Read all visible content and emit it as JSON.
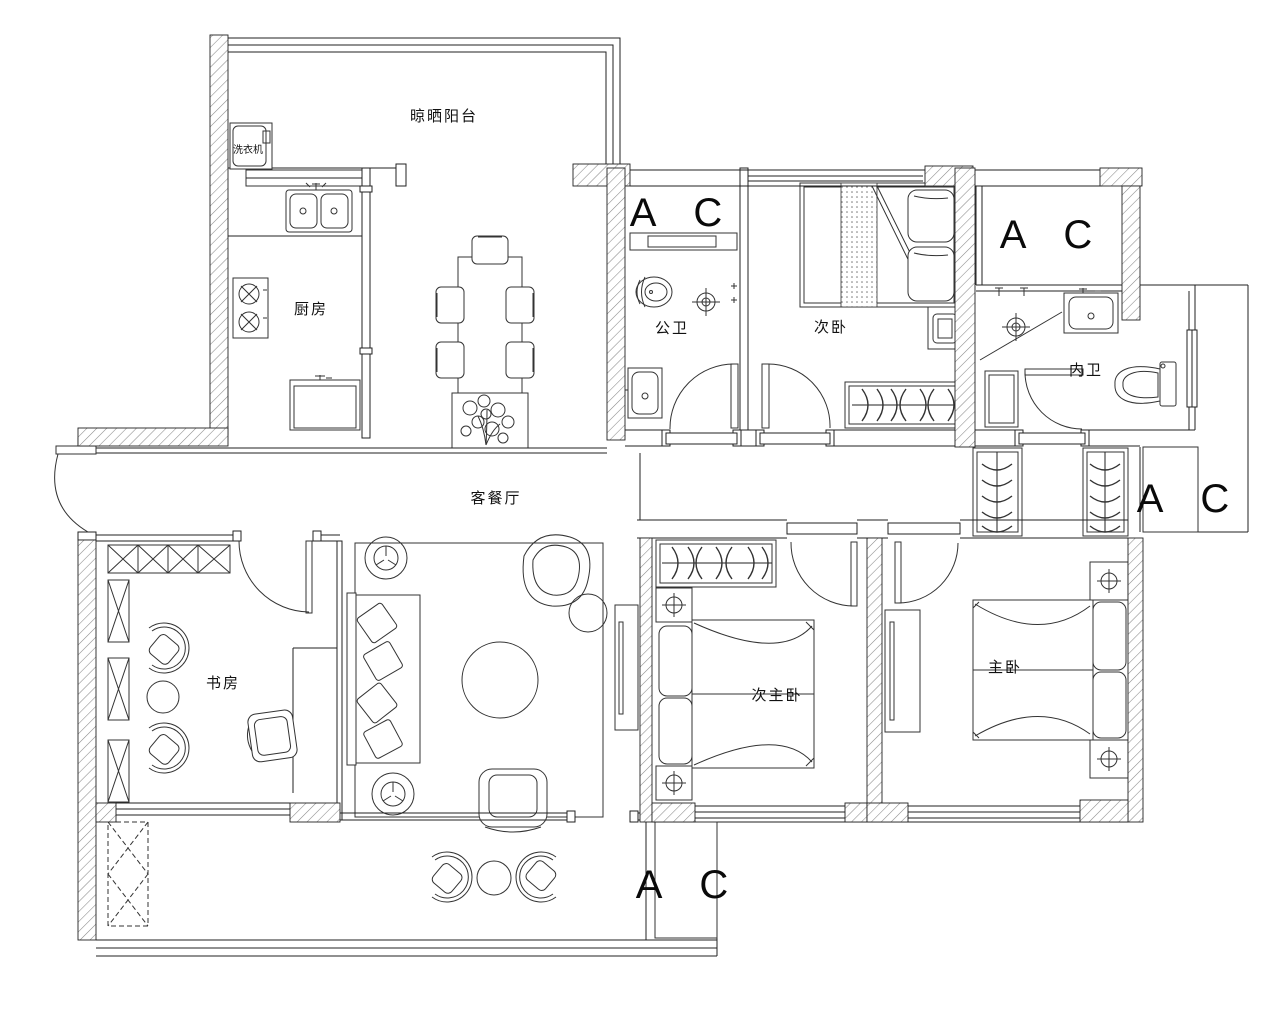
{
  "title": "四室两卫户型平面布置图",
  "colors": {
    "line": "#222222",
    "wall_hatch": "#8a8a8a",
    "background": "#ffffff"
  },
  "labels": {
    "drying_balcony": "晾晒阳台",
    "washing_machine": "洗衣机",
    "kitchen": "厨房",
    "public_bathroom": "公卫",
    "bedroom2": "次卧",
    "ensuite_bathroom": "内卫",
    "living_dining": "客餐厅",
    "study": "书房",
    "second_master_bedroom": "次主卧",
    "master_bedroom": "主卧",
    "ac": "A C"
  }
}
